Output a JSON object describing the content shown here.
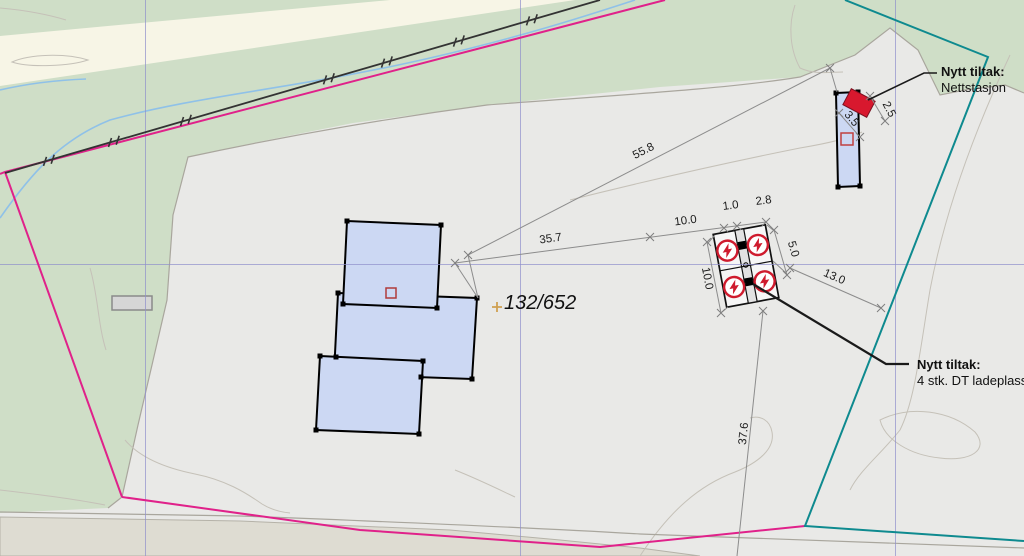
{
  "map": {
    "parcel_label": "132/652",
    "annotations": {
      "nettstasjon": {
        "title": "Nytt tiltak:",
        "subtitle": "Nettstasjon"
      },
      "ladeplasser": {
        "title": "Nytt tiltak:",
        "subtitle": "4 stk. DT ladeplasser"
      }
    },
    "dimensions": {
      "total_diagonal": "55.8",
      "to_station": "35.7",
      "chain_ten": "10.0",
      "strip_width": "1.0",
      "stall_width": "2.8",
      "stall_depth": "5.0",
      "station_length": "10.0",
      "clearance": "13.0",
      "to_boundary": "37.6",
      "nettstasjon_width": "3.5",
      "nettstasjon_depth": "2.5"
    },
    "icons": {
      "ev_charger": "lightning-bolt-in-circle"
    },
    "colors": {
      "field": "#e9e9e7",
      "vegetation": "#cfdec7",
      "cream_band": "#f7f5e6",
      "bottom_band": "#dedcd2",
      "building_fill": "#ccd8f3",
      "tiltak_red": "#d8182e",
      "boundary_magenta": "#e0218a",
      "boundary_teal": "#0e8a8f",
      "grid_blue": "#9090cc",
      "parcel_marker_orange": "#cfa052"
    }
  }
}
